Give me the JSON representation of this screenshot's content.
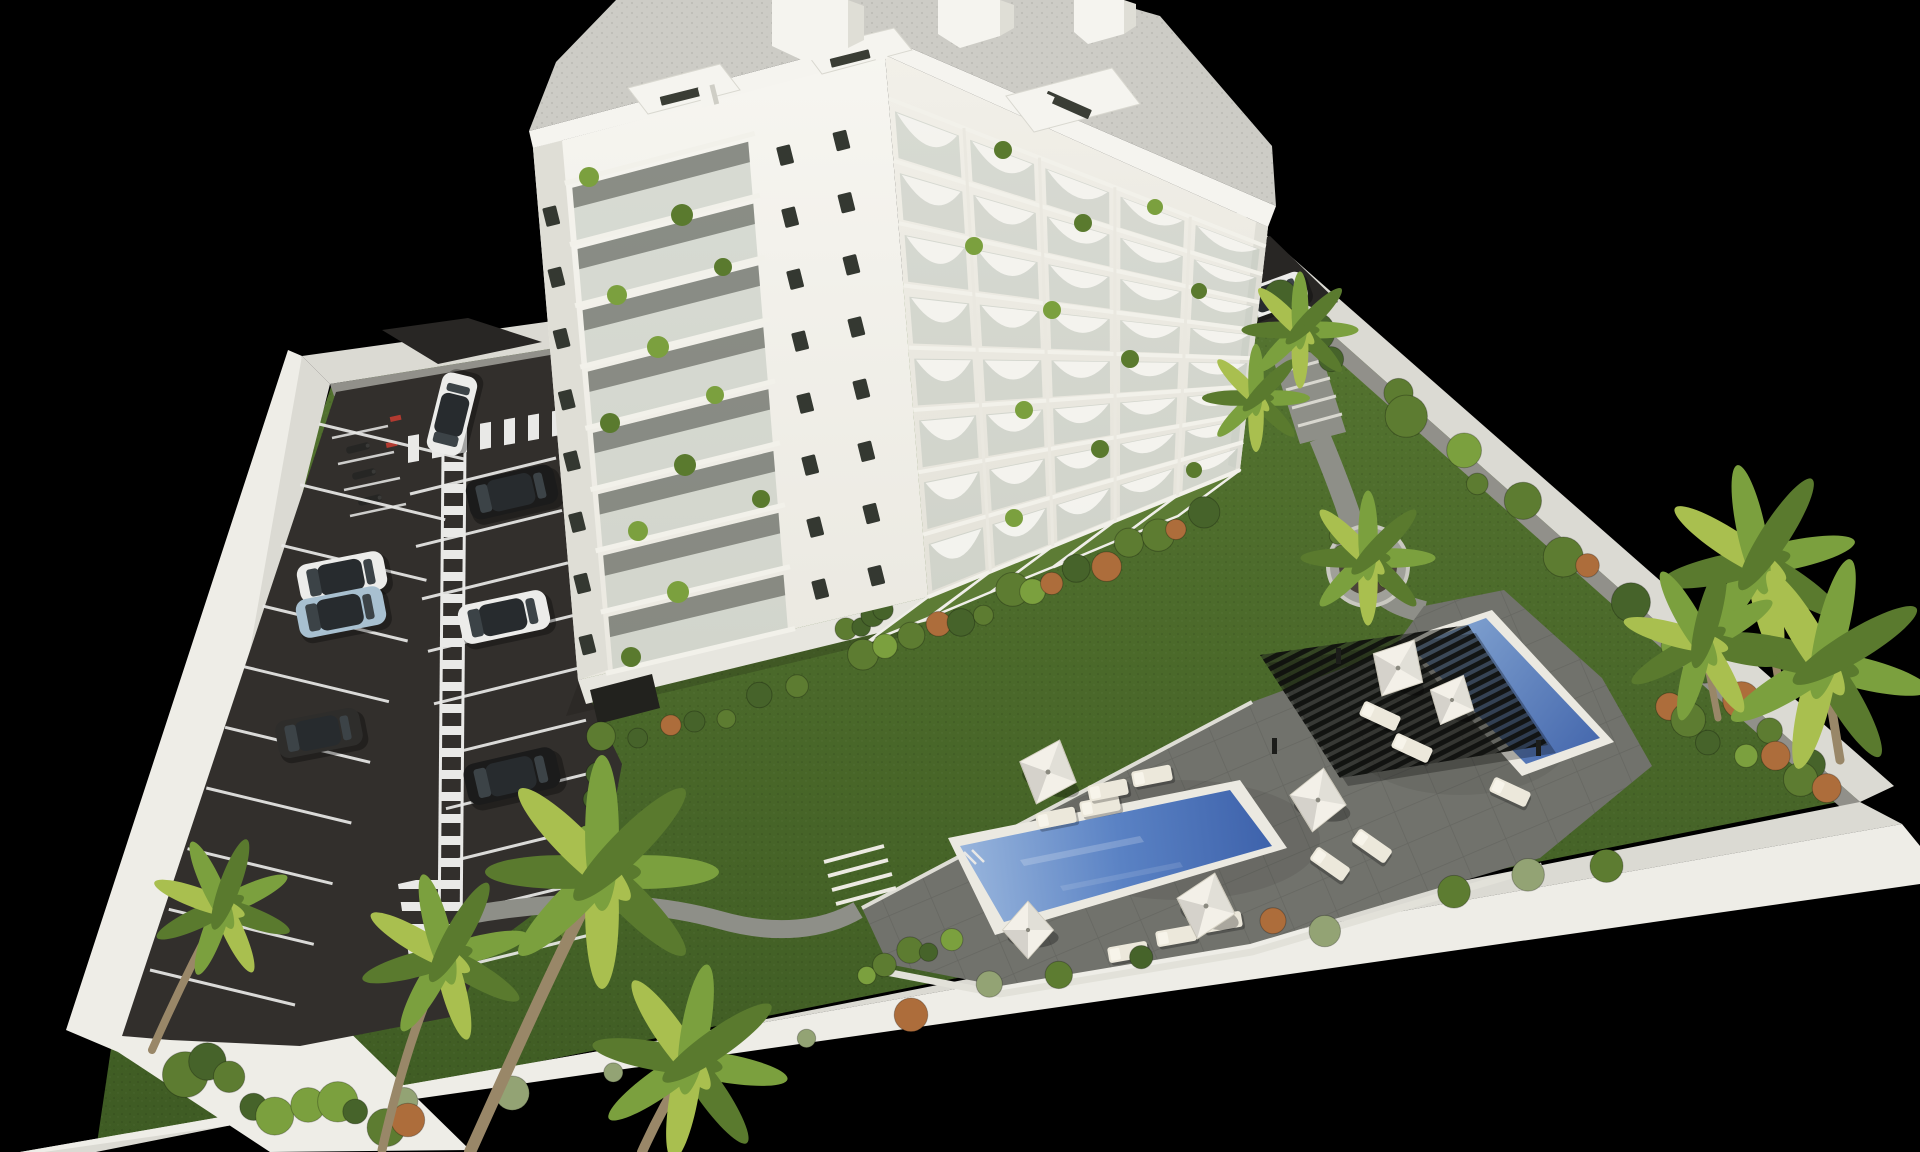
{
  "meta": {
    "title": "Residential complex — aerial 3D architectural render",
    "caption": "Aerial 3D rendering of a modern white apartment block with eight balcony floors, rooftop penthouses, landscaped communal gardens, two blue swimming pools, a black slatted pergola with sun loungers and parasols, private garden terraces, palm trees and a walled residents' parking lot with painted stalls and parked cars, on a black background."
  },
  "inventory": {
    "building_floors": 8,
    "arched_balcony_columns": 5,
    "parking_rows": 2,
    "cars": 8,
    "car_colors": [
      "white",
      "black",
      "white",
      "light-blue",
      "white",
      "dark-gray",
      "black",
      "white"
    ],
    "swimming_pools": 2,
    "pergolas": 1,
    "parasols": 6,
    "sun_loungers": 12,
    "round_planters": 1,
    "private_terraces": 5,
    "palm_trees": 10
  },
  "palette": {
    "bg": "#000000",
    "grass1": "#557530",
    "grass2": "#3e5b23",
    "grassLight": "#5d7c35",
    "asphalt": "#322f2c",
    "asphaltDark": "#282624",
    "lineWhite": "#e9e9e7",
    "wallTop": "#dbdad3",
    "wallLight": "#eeede7",
    "wallShadow": "#91908a",
    "white": "#f5f4ef",
    "buildingShade": "#e7e6df",
    "facadeSide": "#dfded6",
    "glass": "#b9c1b7",
    "windowDark": "#343831",
    "slab": "#f2f1ea",
    "roofGravel": "#cdccc6",
    "deck": "#71726c",
    "coping": "#ebe9e1",
    "waterL": "#9db9de",
    "waterM": "#5a82c4",
    "waterD": "#3a5ea8",
    "pergola": "#1f201d",
    "canopy": "#f3f0e8",
    "lounger": "#ece8db",
    "planter": "#a0a099",
    "soil": "#4b4339",
    "palmG": "#7ba03e",
    "palmD": "#5a7a2e",
    "palmY": "#a9bf4f",
    "shrubG": "#5d7c31",
    "shrubD": "#46632a",
    "shrubO": "#ad6d3b",
    "shrubPale": "#93a374",
    "trunk": "#998768",
    "path": "#8e8f88",
    "carWhite": "#ececea",
    "carBlack": "#1b1b1b",
    "carBlue": "#a8c0d0",
    "carDark": "#2e2d2b"
  },
  "scene": {
    "facades": {
      "sw": {
        "edges": {
          "L0": [
            533,
            148
          ],
          "L1": [
            578,
            680
          ],
          "R0": [
            885,
            55
          ],
          "R1": [
            928,
            597
          ]
        },
        "rows": 8,
        "t0": 0.08,
        "stack": [
          0.1,
          0.6
        ],
        "windows_u": [
          0.035,
          0.7,
          0.86
        ],
        "window_rot": -14
      },
      "se": {
        "edges": {
          "L0": [
            885,
            55
          ],
          "L1": [
            928,
            597
          ],
          "R0": [
            1268,
            227
          ],
          "R1": [
            1240,
            470
          ]
        },
        "rows": 8,
        "t0": 0.08,
        "cols": 5
      }
    },
    "balcony_plants": {
      "sw": [
        [
          589,
          177,
          10
        ],
        [
          682,
          215,
          11
        ],
        [
          617,
          295,
          10
        ],
        [
          723,
          267,
          9
        ],
        [
          658,
          347,
          11
        ],
        [
          610,
          423,
          10
        ],
        [
          715,
          395,
          9
        ],
        [
          685,
          465,
          11
        ],
        [
          638,
          531,
          10
        ],
        [
          761,
          499,
          9
        ],
        [
          678,
          592,
          11
        ],
        [
          631,
          657,
          10
        ]
      ],
      "se": [
        [
          1003,
          150,
          9
        ],
        [
          1155,
          207,
          8
        ],
        [
          1083,
          223,
          9
        ],
        [
          974,
          246,
          9
        ],
        [
          1199,
          291,
          8
        ],
        [
          1052,
          310,
          9
        ],
        [
          1130,
          359,
          9
        ],
        [
          1024,
          410,
          9
        ],
        [
          1100,
          449,
          9
        ],
        [
          1014,
          518,
          9
        ],
        [
          1194,
          470,
          8
        ]
      ]
    },
    "parking_stalls": [
      {
        "p0": [
          319,
          424
        ],
        "p1": [
          150,
          970
        ],
        "n": 10,
        "dir": [
          145,
          35
        ]
      },
      {
        "p0": [
          556,
          458
        ],
        "p1": [
          610,
          930
        ],
        "n": 10,
        "dir": [
          -146,
          36
        ]
      }
    ],
    "vehicles": [
      {
        "x": 452,
        "y": 414,
        "rot": -76,
        "s": 0.9,
        "color": "carWhite"
      },
      {
        "x": 512,
        "y": 492,
        "rot": -13,
        "s": 1.0,
        "color": "carBlack"
      },
      {
        "x": 342,
        "y": 577,
        "rot": -11,
        "s": 0.98,
        "color": "carWhite"
      },
      {
        "x": 341,
        "y": 612,
        "rot": -11,
        "s": 0.98,
        "color": "carBlue"
      },
      {
        "x": 504,
        "y": 617,
        "rot": -12,
        "s": 1.0,
        "color": "carWhite"
      },
      {
        "x": 319,
        "y": 733,
        "rot": -11,
        "s": 0.95,
        "color": "carDark"
      },
      {
        "x": 512,
        "y": 776,
        "rot": -13,
        "s": 1.05,
        "color": "carBlack"
      },
      {
        "x": 1272,
        "y": 296,
        "rot": -20,
        "s": 0.78,
        "color": "carWhite"
      }
    ],
    "umbrellas": [
      {
        "x": 1048,
        "y": 772,
        "s": 1.0,
        "rot": 20
      },
      {
        "x": 1318,
        "y": 800,
        "s": 0.95,
        "rot": 10
      },
      {
        "x": 1398,
        "y": 668,
        "s": 0.95,
        "rot": 30
      },
      {
        "x": 1206,
        "y": 906,
        "s": 1.0,
        "rot": 15
      },
      {
        "x": 1028,
        "y": 930,
        "s": 0.85,
        "rot": 0
      },
      {
        "x": 1452,
        "y": 700,
        "s": 0.8,
        "rot": 25
      }
    ],
    "loungers": [
      {
        "x": 1056,
        "y": 818,
        "rot": -11
      },
      {
        "x": 1100,
        "y": 806,
        "rot": -11
      },
      {
        "x": 1108,
        "y": 790,
        "rot": -11
      },
      {
        "x": 1152,
        "y": 776,
        "rot": -11
      },
      {
        "x": 1330,
        "y": 864,
        "rot": 35
      },
      {
        "x": 1372,
        "y": 846,
        "rot": 35
      },
      {
        "x": 1380,
        "y": 716,
        "rot": 25
      },
      {
        "x": 1412,
        "y": 748,
        "rot": 25
      },
      {
        "x": 1510,
        "y": 792,
        "rot": 25
      },
      {
        "x": 1128,
        "y": 952,
        "rot": -10
      },
      {
        "x": 1176,
        "y": 936,
        "rot": -10
      },
      {
        "x": 1222,
        "y": 922,
        "rot": -10
      }
    ],
    "shrub_rows": [
      {
        "a": [
          1258,
          282
        ],
        "b": [
          1826,
          778
        ],
        "n": 16,
        "seed": 7,
        "rmin": 10,
        "rmax": 22,
        "jit": 10,
        "cols": [
          "shrubG",
          "shrubD",
          "palmG",
          "shrubO",
          "shrubG",
          "shrubD"
        ]
      },
      {
        "a": [
          1660,
          852
        ],
        "b": [
          380,
          1116
        ],
        "n": 14,
        "seed": 11,
        "rmin": 9,
        "rmax": 18,
        "jit": 12,
        "cols": [
          "shrubPale",
          "shrubG",
          "shrubD",
          "shrubPale",
          "shrubO"
        ]
      },
      {
        "a": [
          852,
          664
        ],
        "b": [
          1216,
          514
        ],
        "n": 15,
        "seed": 3,
        "rmin": 9,
        "rmax": 17,
        "jit": 8,
        "cols": [
          "shrubG",
          "shrubO",
          "shrubD",
          "palmG",
          "shrubG"
        ]
      },
      {
        "a": [
          600,
          718
        ],
        "b": [
          570,
          948
        ],
        "n": 7,
        "seed": 5,
        "rmin": 9,
        "rmax": 15,
        "jit": 7,
        "cols": [
          "shrubG",
          "shrubD",
          "palmG"
        ]
      },
      {
        "a": [
          856,
          984
        ],
        "b": [
          960,
          930
        ],
        "n": 5,
        "seed": 9,
        "rmin": 8,
        "rmax": 14,
        "jit": 8,
        "cols": [
          "shrubG",
          "palmG",
          "shrubD"
        ]
      },
      {
        "a": [
          1652,
          700
        ],
        "b": [
          1842,
          798
        ],
        "n": 7,
        "seed": 13,
        "rmin": 10,
        "rmax": 18,
        "jit": 14,
        "cols": [
          "shrubG",
          "shrubD",
          "palmG",
          "shrubO"
        ]
      },
      {
        "a": [
          1166,
          352
        ],
        "b": [
          1254,
          322
        ],
        "n": 5,
        "seed": 17,
        "rmin": 10,
        "rmax": 16,
        "jit": 10,
        "cols": [
          "shrubD",
          "shrubG"
        ]
      },
      {
        "a": [
          836,
          632
        ],
        "b": [
          892,
          606
        ],
        "n": 4,
        "seed": 21,
        "rmin": 9,
        "rmax": 13,
        "jit": 8,
        "cols": [
          "shrubG",
          "shrubD"
        ]
      },
      {
        "a": [
          1330,
          520
        ],
        "b": [
          1390,
          600
        ],
        "n": 4,
        "seed": 23,
        "rmin": 8,
        "rmax": 12,
        "jit": 12,
        "cols": [
          "shrubG",
          "palmG"
        ]
      },
      {
        "a": [
          170,
          1060
        ],
        "b": [
          420,
          1140
        ],
        "n": 10,
        "seed": 27,
        "rmin": 12,
        "rmax": 24,
        "jit": 22,
        "cols": [
          "shrubG",
          "shrubD",
          "palmG",
          "shrubO"
        ]
      },
      {
        "a": [
          610,
          740
        ],
        "b": [
          820,
          688
        ],
        "n": 6,
        "seed": 31,
        "rmin": 9,
        "rmax": 14,
        "jit": 8,
        "cols": [
          "shrubG",
          "shrubD",
          "shrubO"
        ]
      }
    ],
    "palms": {
      "trunks": [
        "M470,1152 C505,1075 558,955 602,872",
        "M382,1150 C402,1062 424,1000 445,957",
        "M642,1152 C660,1112 676,1086 690,1062",
        "M152,1050 C182,982 204,940 222,907",
        "M1780,690 C1772,640 1766,600 1758,562",
        "M1840,760 C1834,724 1830,696 1824,664",
        "M1718,718 C1712,688 1708,664 1702,642",
        "M1368,590 L1366,560",
        "M1258,432 L1255,400",
        "M1302,360 L1300,332"
      ],
      "widths": [
        12,
        9,
        10,
        8,
        8,
        9,
        7,
        5,
        4,
        5
      ],
      "heads": [
        {
          "x": 602,
          "y": 872,
          "s": 2.6,
          "rot": 0
        },
        {
          "x": 445,
          "y": 957,
          "s": 1.9,
          "rot": -15
        },
        {
          "x": 690,
          "y": 1062,
          "s": 2.2,
          "rot": 10
        },
        {
          "x": 222,
          "y": 907,
          "s": 1.6,
          "rot": -25
        },
        {
          "x": 1758,
          "y": 562,
          "s": 2.2,
          "rot": -12
        },
        {
          "x": 1824,
          "y": 664,
          "s": 2.4,
          "rot": 14
        },
        {
          "x": 1702,
          "y": 642,
          "s": 1.8,
          "rot": -30
        },
        {
          "x": 1368,
          "y": 558,
          "s": 1.5,
          "rot": 0
        },
        {
          "x": 1256,
          "y": 398,
          "s": 1.2,
          "rot": 0
        },
        {
          "x": 1300,
          "y": 330,
          "s": 1.3,
          "rot": 0
        }
      ]
    }
  }
}
